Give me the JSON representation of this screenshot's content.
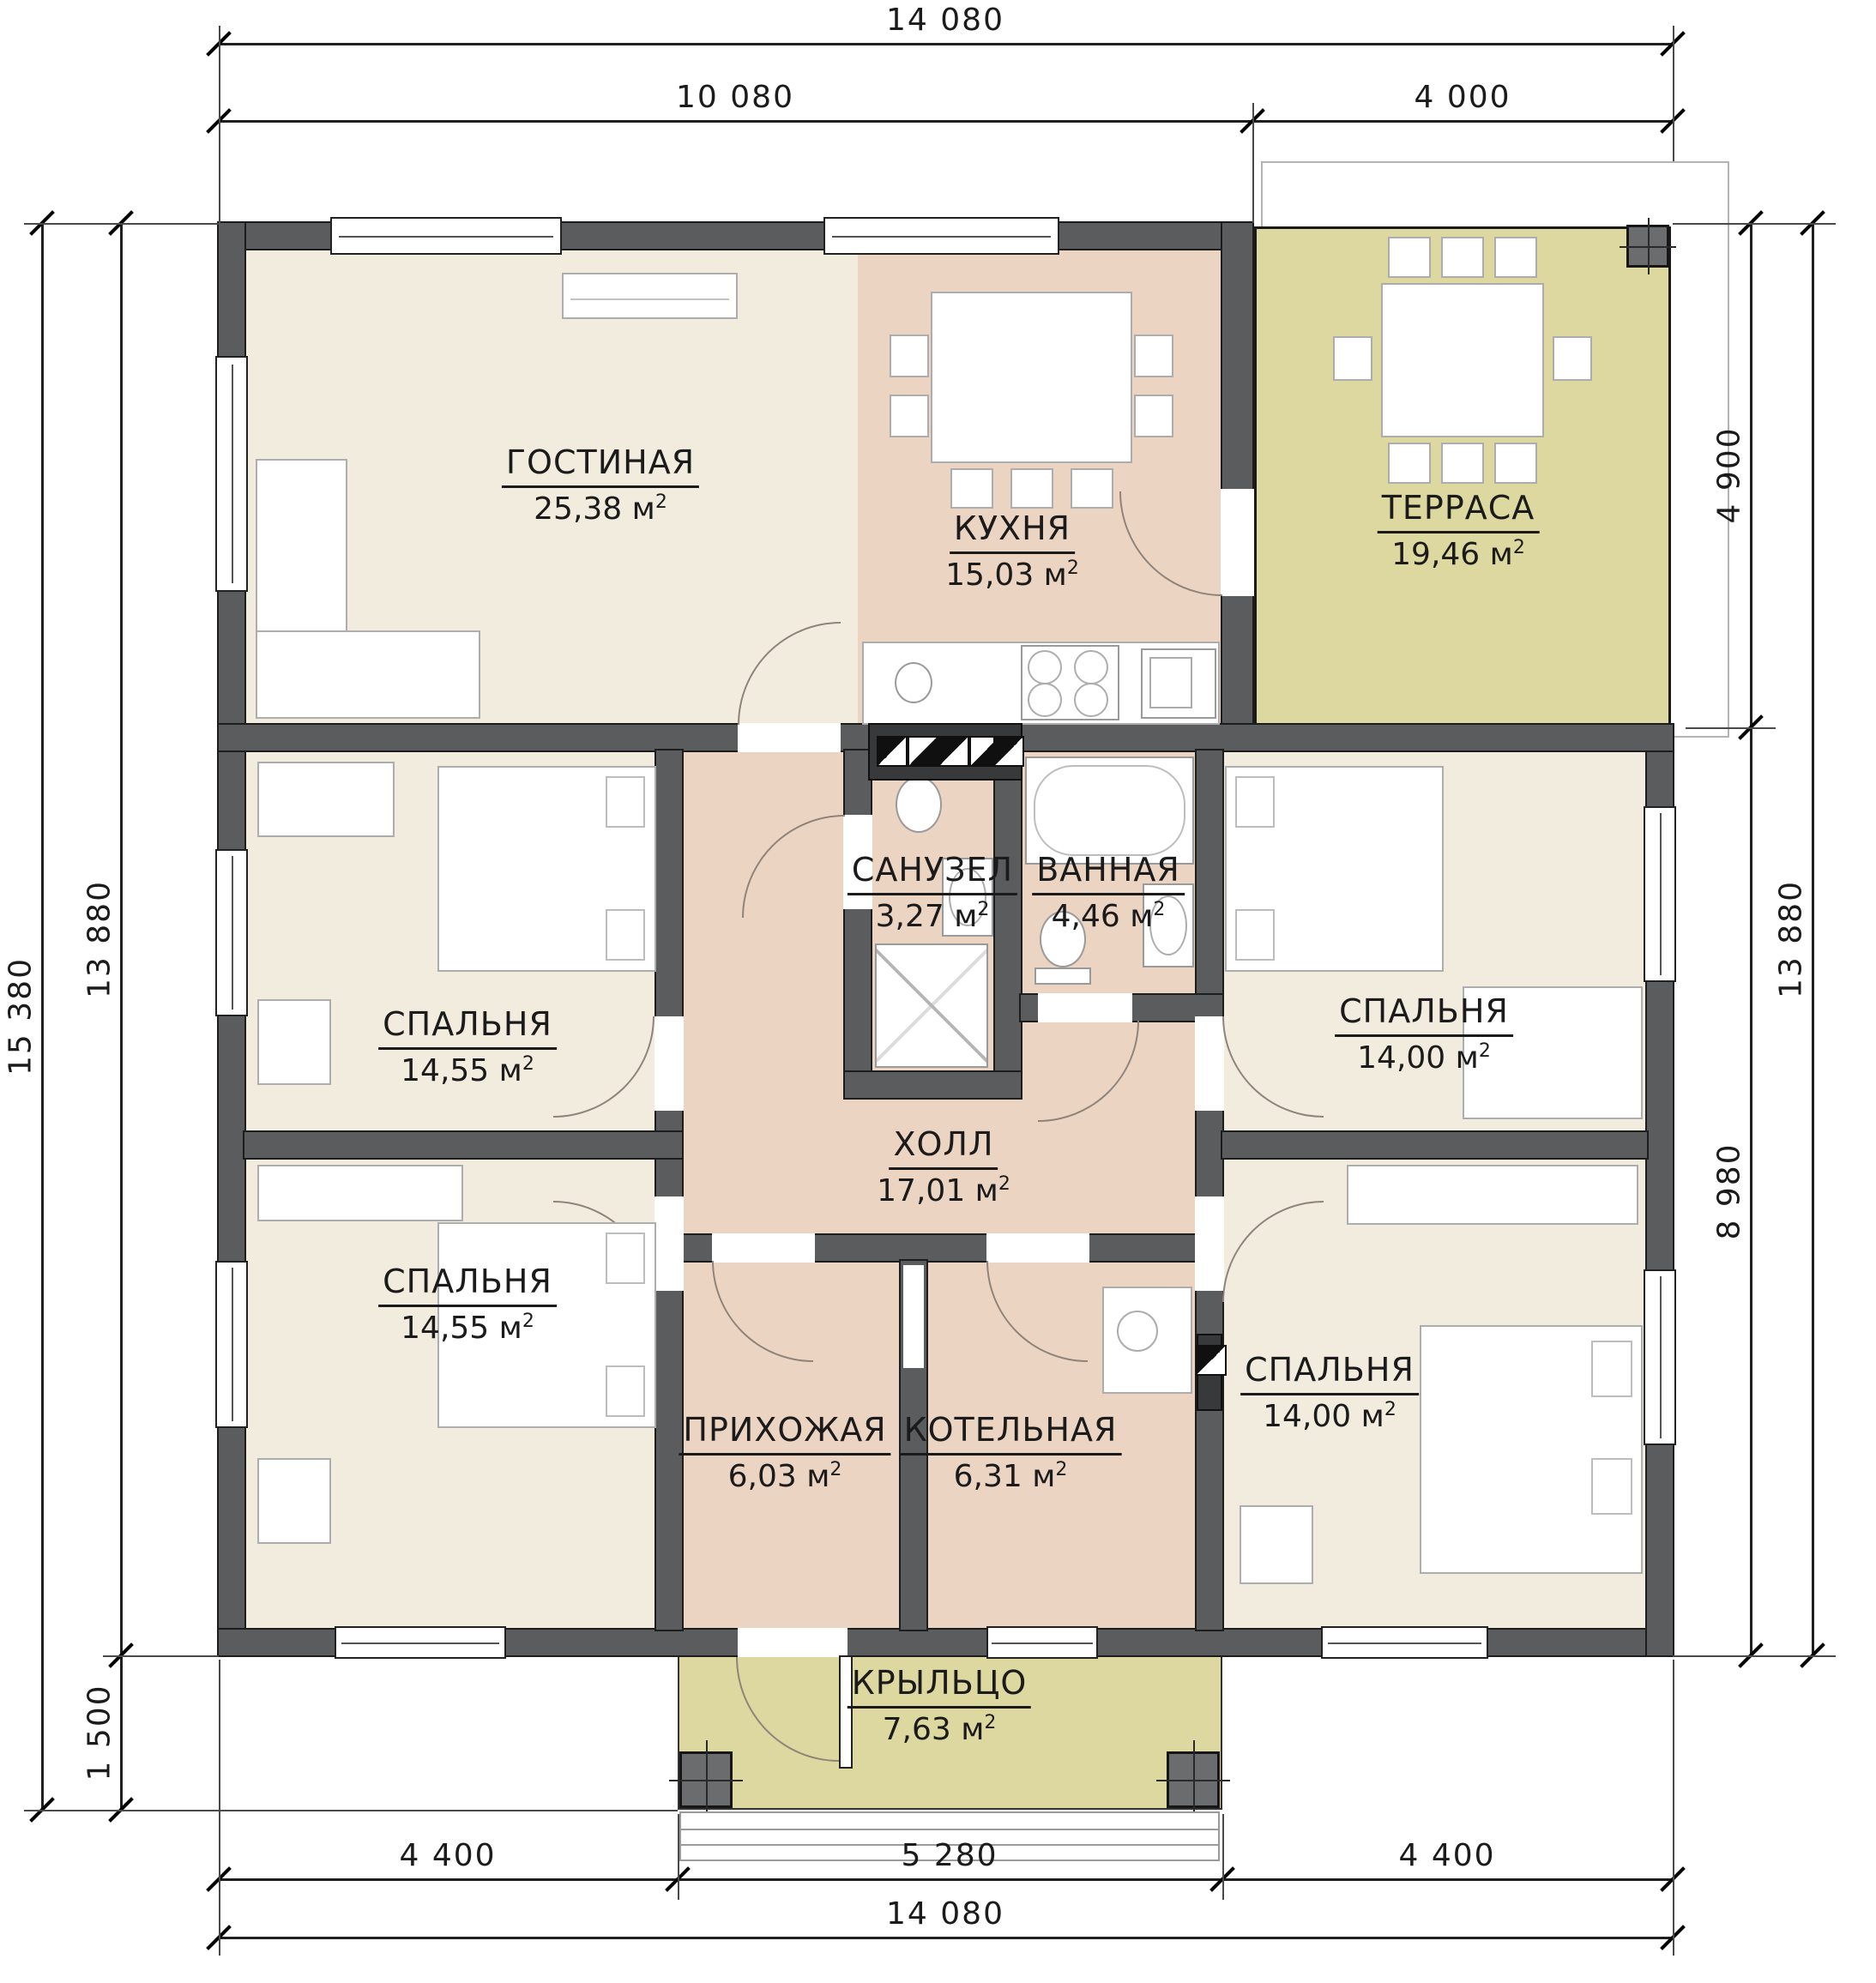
{
  "units": {
    "area_unit": "м",
    "area_sup": "2"
  },
  "rooms": {
    "living": {
      "name": "ГОСТИНАЯ",
      "area": "25,38"
    },
    "kitchen": {
      "name": "КУХНЯ",
      "area": "15,03"
    },
    "terrace": {
      "name": "ТЕРРАСА",
      "area": "19,46"
    },
    "wc": {
      "name": "САНУЗЕЛ",
      "area": "3,27"
    },
    "bath": {
      "name": "ВАННАЯ",
      "area": "4,46"
    },
    "bedroom_tl": {
      "name": "СПАЛЬНЯ",
      "area": "14,55"
    },
    "bedroom_tr": {
      "name": "СПАЛЬНЯ",
      "area": "14,00"
    },
    "hall": {
      "name": "ХОЛЛ",
      "area": "17,01"
    },
    "bedroom_bl": {
      "name": "СПАЛЬНЯ",
      "area": "14,55"
    },
    "bedroom_br": {
      "name": "СПАЛЬНЯ",
      "area": "14,00"
    },
    "entry": {
      "name": "ПРИХОЖАЯ",
      "area": "6,03"
    },
    "boiler": {
      "name": "КОТЕЛЬНАЯ",
      "area": "6,31"
    },
    "porch": {
      "name": "КРЫЛЬЦО",
      "area": "7,63"
    }
  },
  "dimensions": {
    "top_total": "14 080",
    "top_main": "10 080",
    "top_terrace": "4 000",
    "bottom_left": "4 400",
    "bottom_center": "5 280",
    "bottom_right": "4 400",
    "bottom_total": "14 080",
    "left_total": "15 380",
    "left_house": "13 880",
    "left_porch": "1 500",
    "right_house": "13 880",
    "right_terrace": "4 900",
    "right_bedrooms": "8 980"
  },
  "colors": {
    "floor_cream": "#f2ecdf",
    "floor_warm": "#ecd4c3",
    "floor_olive": "#ddd7a0",
    "wall": "#5b5c5e"
  }
}
